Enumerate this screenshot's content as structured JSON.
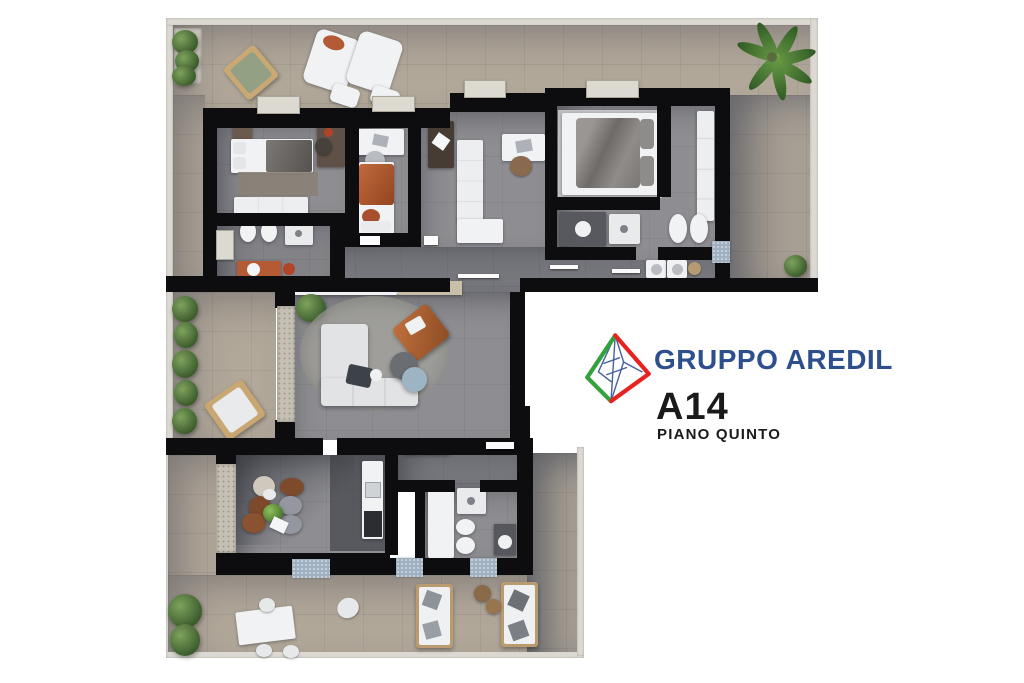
{
  "branding": {
    "company": "GRUPPO AREDIL",
    "unit": "A14",
    "floor": "PIANO QUINTO"
  },
  "palette": {
    "background": "#ffffff",
    "wall": "#0d0d0f",
    "terrace-floor": "#b2a89a",
    "terrace-floor-2": "#a9a196",
    "interior-floor": "#8e8e92",
    "interior-floor-dark": "#77787d",
    "kitchen-dark": "#46474d",
    "parapet": "#dcd9d3",
    "stone": "#c6c0b4",
    "furniture-white": "#f1f2f4",
    "sofa-gray": "#e2e3e5",
    "terracotta": "#b45a35",
    "rug-brown": "#8a8175",
    "plant-green": "#5d7c49",
    "wood": "#a87c4f",
    "mat-blue": "#9fb0c1",
    "brand-navy": "#2e4f8e",
    "logo-green": "#33a23d",
    "logo-red": "#e8231f",
    "logo-blue": "#46619e",
    "text-black": "#1a1a1a"
  }
}
